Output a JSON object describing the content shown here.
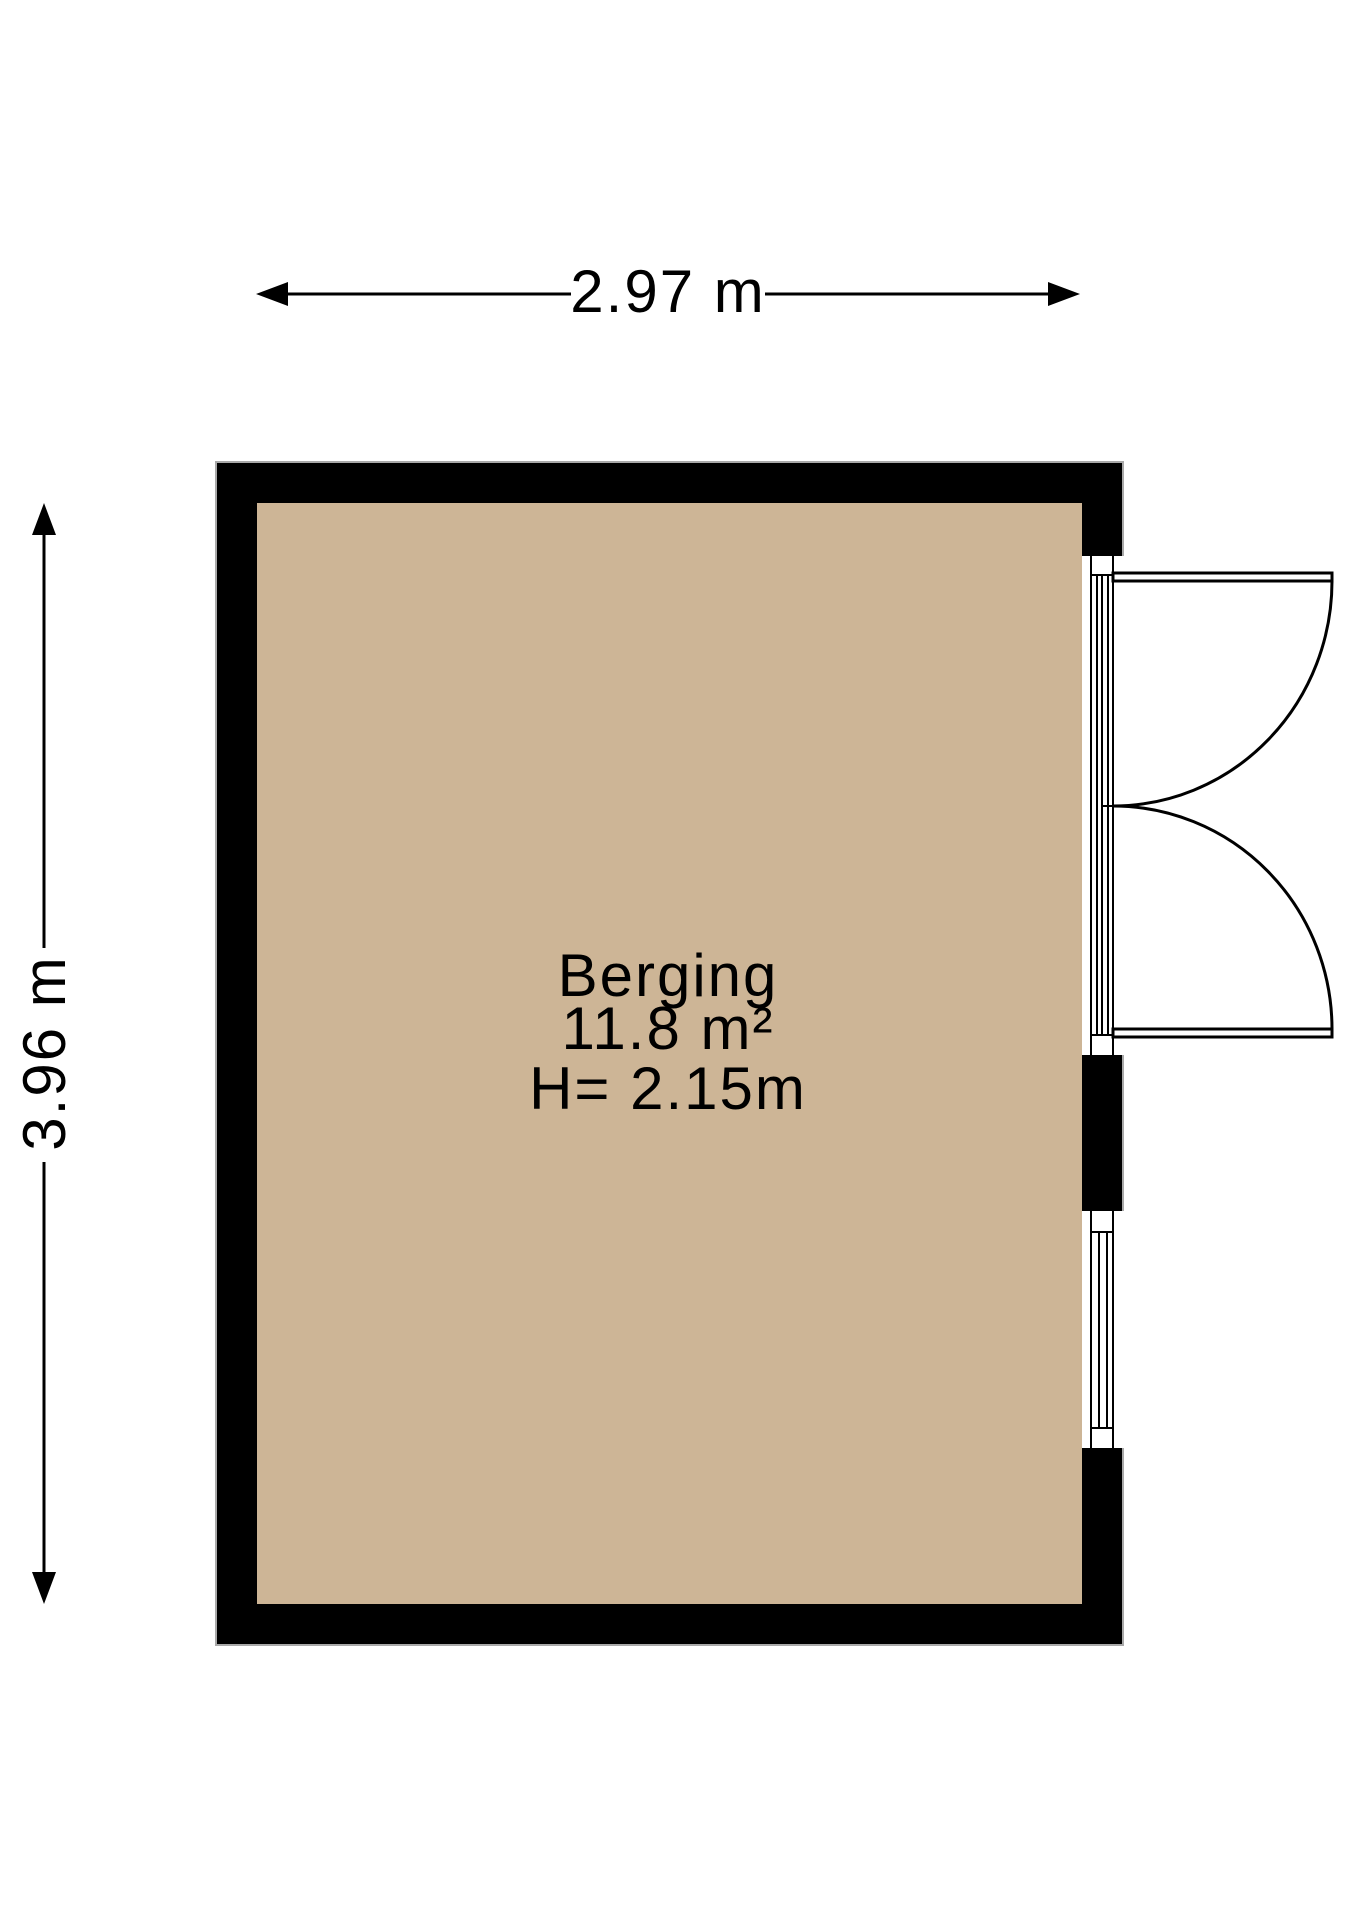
{
  "floorplan": {
    "room": {
      "name": "Berging",
      "area": "11.8 m²",
      "ceiling_height": "H= 2.15m"
    },
    "dimensions": {
      "width_label": "2.97 m",
      "height_label": "3.96 m"
    },
    "features": {
      "door": "double-swing-door-right-wall",
      "window": "window-right-wall-lower"
    },
    "colors": {
      "floor": "#cdb596",
      "wall": "#000000",
      "outline": "#a9a9a9",
      "text": "#000000",
      "background": "#ffffff"
    }
  }
}
